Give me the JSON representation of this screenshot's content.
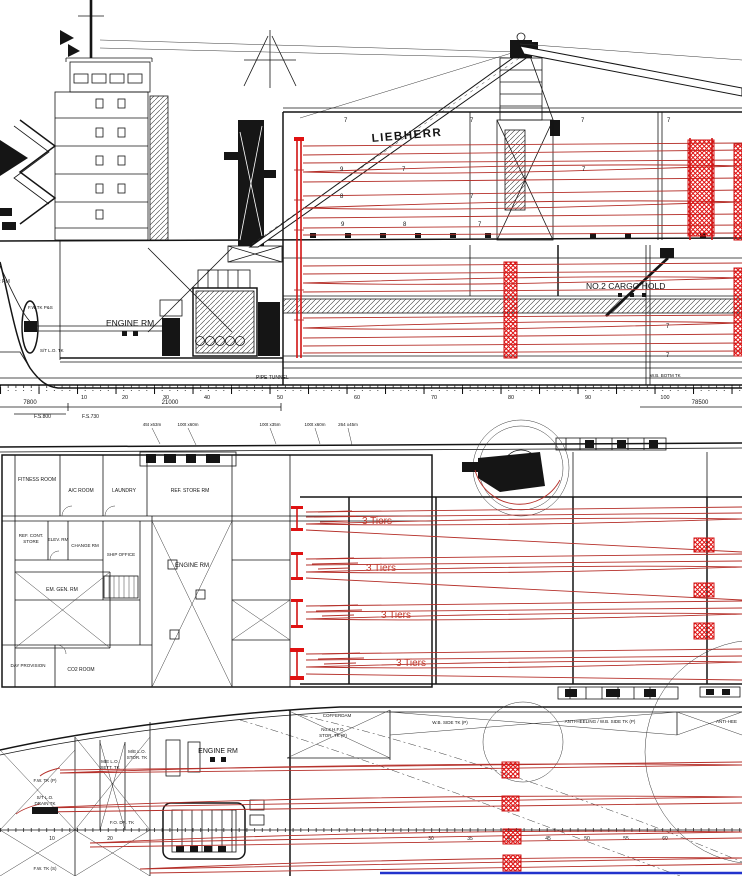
{
  "colors": {
    "ink": "#151515",
    "red_line": "#b5302a",
    "red_bright": "#e01212",
    "blue_line": "#2233cc",
    "background": "#ffffff"
  },
  "profile": {
    "crane_brand": "LIEBHERR",
    "engine_rm": "ENGINE RM",
    "cargo_hold": "NO.2 CARGO HOLD",
    "pipe_tunnel": "PIPE TUNNEL",
    "steer_rm": "STEER RM",
    "fw_tk": "F.W.TK P&S",
    "st_lo_tk": "S/T L.O. TK",
    "wb_botm_tk": "W.B. BOTM TK",
    "hold_numbers": [
      "7",
      "7",
      "7",
      "7",
      "9",
      "7",
      "7",
      "8",
      "7",
      "9",
      "8",
      "7",
      "7",
      "7"
    ],
    "frame_numbers": [
      "10",
      "20",
      "30",
      "40",
      "50",
      "60",
      "70",
      "80",
      "90",
      "100"
    ],
    "dim_7800": "7800",
    "dim_21000": "21000",
    "dim_78500": "78500",
    "fs_800": "F.S.800",
    "fs_730": "F.S.730"
  },
  "deck": {
    "winch_labels": [
      "45t x63m",
      "100t x60m",
      "100t x35m",
      "100t x60m",
      "264 x45m"
    ],
    "rooms": {
      "fitness": "FITNESS ROOM",
      "ac": "A/C ROOM",
      "laundry": "LAUNDRY",
      "ref_store": "REF. STORE RM",
      "ref_cont_1": "REF. CONT.",
      "ref_cont_2": "STORE",
      "elev": "ELEV. RM",
      "change": "CHANGE RM",
      "office": "SHIP OFFICE",
      "em_gen": "EM. GEN. RM",
      "day_prov": "DAY PROVISION",
      "co2": "CO2 ROOM",
      "engine": "ENGINE RM"
    },
    "tiers": [
      "3 Tiers",
      "3 Tiers",
      "3 Tiers",
      "3 Tiers"
    ]
  },
  "tank": {
    "engine_rm": "ENGINE RM",
    "cofferdam": "COFFERDAM",
    "hfo_1": "No.3 H.F.O.",
    "hfo_2": "STOR. TK (P)",
    "wb_side": "W.B. SIDE TK (P)",
    "anti_heel": "ANTI-HEELING / W.B. SIDE TK (P)",
    "anti_heel_right": "ANTI-HEE",
    "fw_p": "F.W. TK (P)",
    "fw_s": "F.W. TK (S)",
    "st_lo_1": "S/T L.O.",
    "st_lo_2": "DRAIN TK",
    "me_sett_1": "M/E L.O.",
    "me_sett_2": "SETT. TK",
    "me_stor_1": "M/E L.O.",
    "me_stor_2": "STOR. TK",
    "fo_dr": "F.O. DR. TK",
    "frame_numbers": [
      "10",
      "20",
      "30",
      "35",
      "40",
      "45",
      "50",
      "55",
      "60"
    ]
  }
}
